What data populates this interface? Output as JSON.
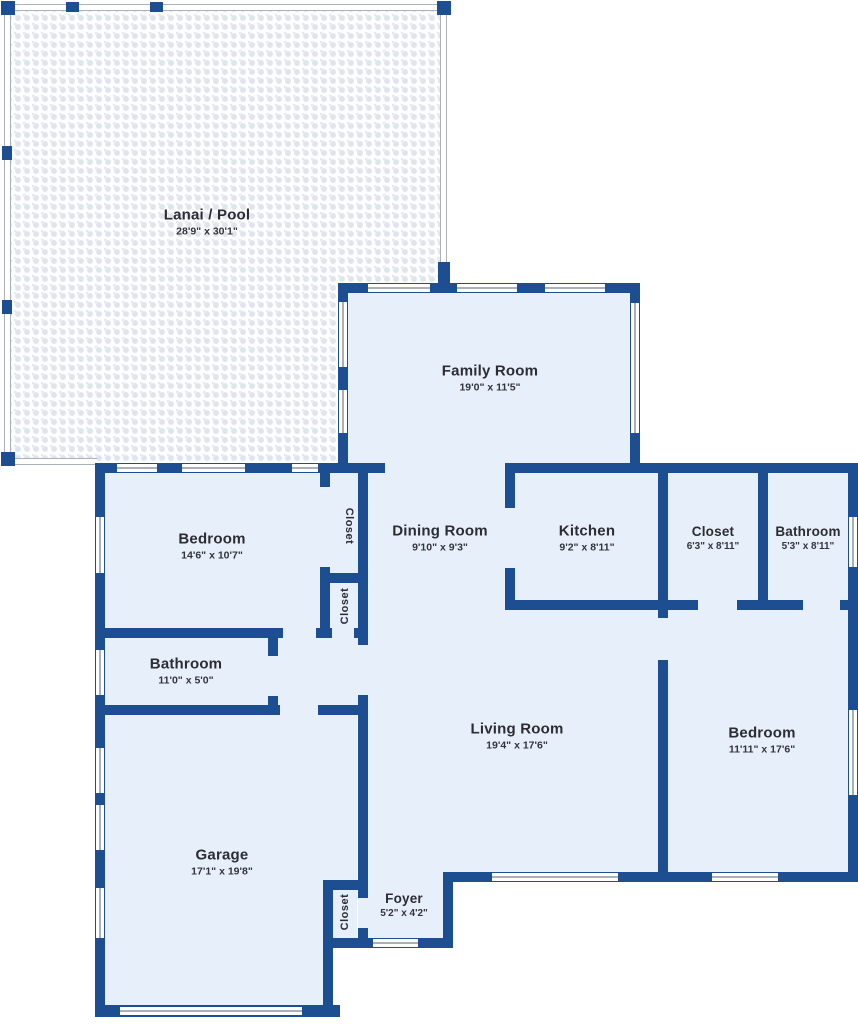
{
  "title": "Residential floor plan",
  "rooms": {
    "lanai": {
      "name": "Lanai / Pool",
      "dims": "28'9\" x 30'1\""
    },
    "family_room": {
      "name": "Family Room",
      "dims": "19'0\" x 11'5\""
    },
    "bedroom_left": {
      "name": "Bedroom",
      "dims": "14'6\" x 10'7\""
    },
    "closet_a": {
      "name": "Closet"
    },
    "closet_b": {
      "name": "Closet"
    },
    "dining_room": {
      "name": "Dining Room",
      "dims": "9'10\" x 9'3\""
    },
    "kitchen": {
      "name": "Kitchen",
      "dims": "9'2\" x 8'11\""
    },
    "closet_right": {
      "name": "Closet",
      "dims": "6'3\" x 8'11\""
    },
    "bathroom_top": {
      "name": "Bathroom",
      "dims": "5'3\" x 8'11\""
    },
    "bathroom_left": {
      "name": "Bathroom",
      "dims": "11'0\" x 5'0\""
    },
    "living_room": {
      "name": "Living Room",
      "dims": "19'4\" x 17'6\""
    },
    "bedroom_right": {
      "name": "Bedroom",
      "dims": "11'11\" x 17'6\""
    },
    "garage": {
      "name": "Garage",
      "dims": "17'1\" x 19'8\""
    },
    "closet_entry": {
      "name": "Closet"
    },
    "foyer": {
      "name": "Foyer",
      "dims": "5'2\" x 4'2\""
    }
  },
  "colors": {
    "wall": "#1d4e91",
    "room_fill": "#e7f0fa",
    "lanai_fill": "#fcfdfe",
    "window_line": "#a9b0b9",
    "text": "#2c2c33"
  }
}
